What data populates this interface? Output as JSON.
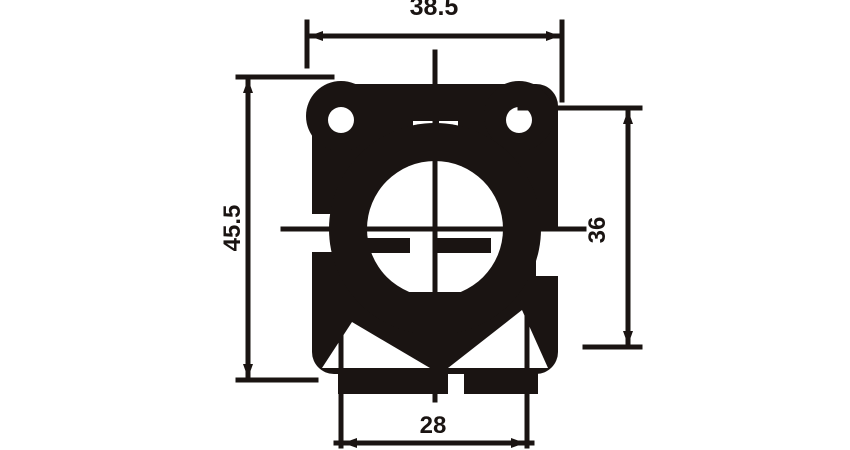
{
  "drawing": {
    "type": "mechanical-dimension-drawing",
    "ink_color": "#1a1412",
    "background_color": "#ffffff",
    "dimensions": {
      "top_width": "38.5",
      "left_height": "45.5",
      "right_height": "36",
      "bottom_spacing": "28"
    }
  }
}
